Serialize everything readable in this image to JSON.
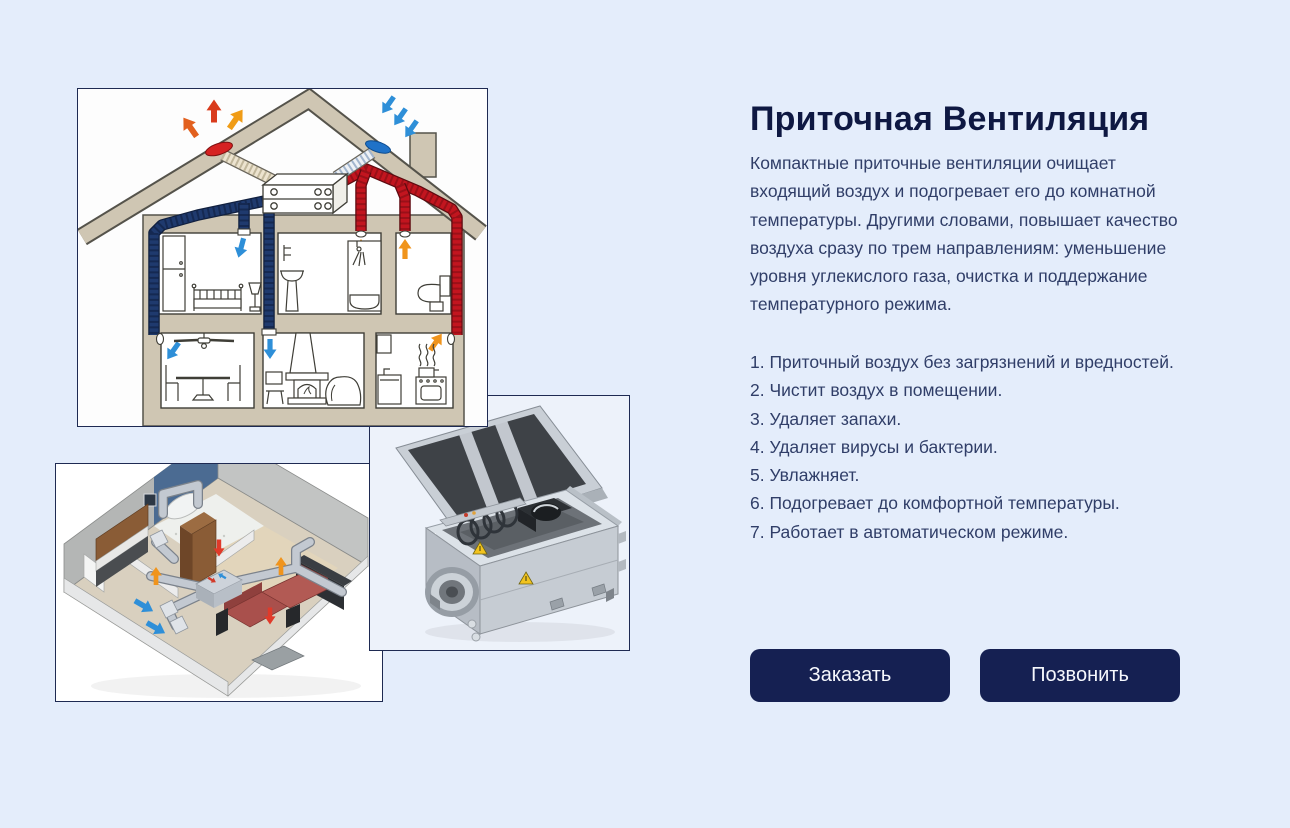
{
  "hero": {
    "title": "Приточная Вентиляция",
    "description_lines": [
      "Компактные приточные вентиляции очищает",
      "входящий воздух и подогревает его до комнатной",
      "температуры. Другими словами, повышает качество",
      "воздуха сразу по трем направлениям: уменьшение",
      "уровня углекислого газа, очистка и поддержание",
      "температурного режима."
    ],
    "features": [
      "1. Приточный воздух без загрязнений и вредностей.",
      "2. Чистит воздух в помещении.",
      "3. Удаляет запахи.",
      "4. Удаляет вирусы и бактерии.",
      "5. Увлажняет.",
      "6. Подогревает до комфортной температуры.",
      "7. Работает в автоматическом режиме."
    ],
    "buttons": {
      "order": "Заказать",
      "call": "Позвонить"
    }
  },
  "images": {
    "house_diagram": "house-ventilation-cutaway-diagram",
    "apartment_3d": "apartment-duct-system-3d-render",
    "unit_photo": "supply-ventilation-unit-photo"
  },
  "colors": {
    "page_background": "#e4edfb",
    "accent_button": "#152052",
    "title_text": "#0e1842",
    "body_text": "#303e68",
    "supply_duct_blue": "#1f3a6e",
    "exhaust_duct_red": "#c2151f"
  }
}
